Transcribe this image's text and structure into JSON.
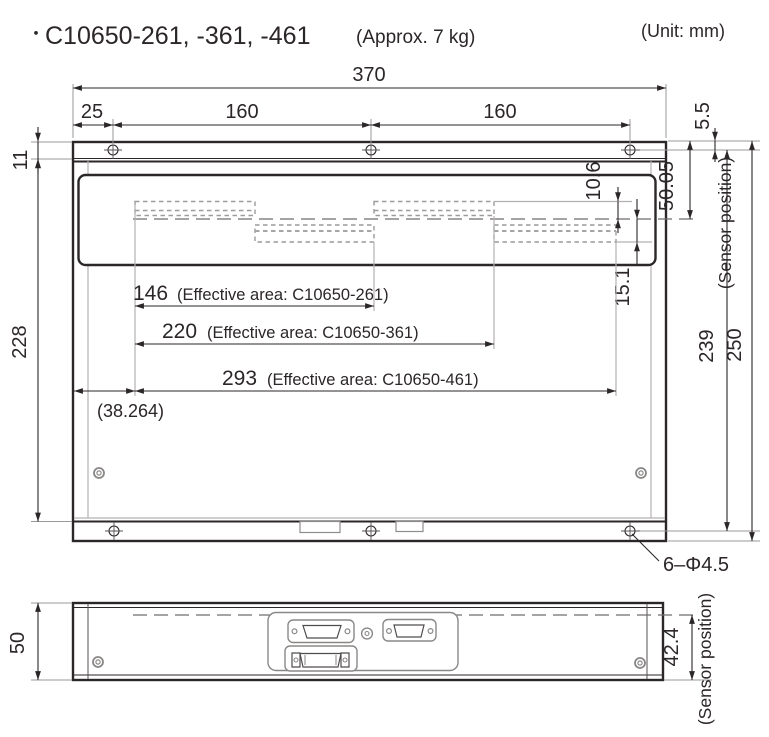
{
  "header": {
    "bullet": "・",
    "model": "C10650-261, -361, -461",
    "weight_note": "(Approx. 7 kg)",
    "unit_note": "(Unit: mm)"
  },
  "front_view": {
    "top": {
      "overall": "370",
      "offset": "25",
      "pitch_a": "160",
      "pitch_b": "160"
    },
    "left": {
      "flange": "11",
      "body": "228"
    },
    "right": {
      "hole_offset": "5.5",
      "sensor_top": "50.05",
      "sensor_label": "(Sensor position)",
      "strip_upper": "10.6",
      "strip_lower": "15.1",
      "inner": "239",
      "overall": "250"
    },
    "eff": [
      {
        "value": "146",
        "label": "(Effective area: C10650-261)"
      },
      {
        "value": "220",
        "label": "(Effective area: C10650-361)"
      },
      {
        "value": "293",
        "label": "(Effective area: C10650-461)"
      }
    ],
    "offset_ref": "(38.264)",
    "holes": "6–Φ4.5"
  },
  "side_view": {
    "height": "50",
    "sensor_offset": "42.4",
    "sensor_label": "(Sensor position)"
  }
}
